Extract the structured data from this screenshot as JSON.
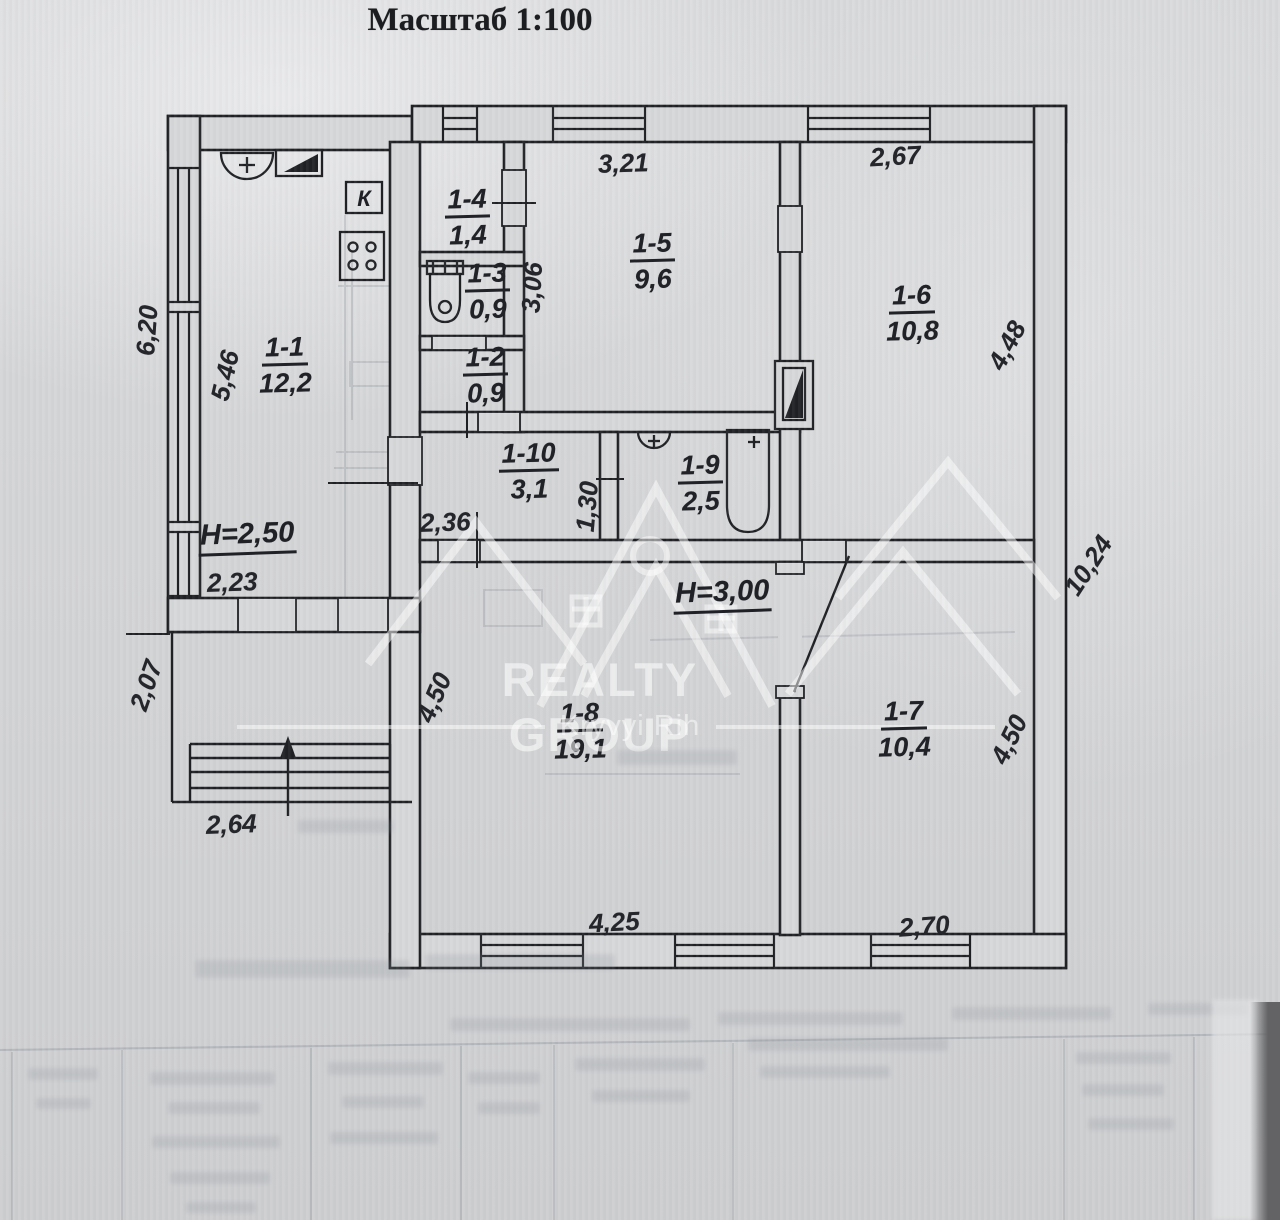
{
  "title": "Масштаб 1:100",
  "plan": {
    "kitchen_marker": "К",
    "watermark": {
      "brand": "REALTY GROUP",
      "city": "Kryvyi Rih"
    },
    "heights": {
      "wing": "Н=2,50",
      "main": "Н=3,00"
    },
    "rooms": [
      {
        "number": "1-1",
        "area": "12,2"
      },
      {
        "number": "1-2",
        "area": "0,9"
      },
      {
        "number": "1-3",
        "area": "0,9"
      },
      {
        "number": "1-4",
        "area": "1,4"
      },
      {
        "number": "1-5",
        "area": "9,6"
      },
      {
        "number": "1-6",
        "area": "10,8"
      },
      {
        "number": "1-7",
        "area": "10,4"
      },
      {
        "number": "1-8",
        "area": "19,1"
      },
      {
        "number": "1-9",
        "area": "2,5"
      },
      {
        "number": "1-10",
        "area": "3,1"
      }
    ],
    "dimensions": {
      "left_outer": "6,20",
      "room11_left": "5,46",
      "top_room15": "3,21",
      "top_room16": "2,67",
      "corridor_vert": "3,06",
      "room16_right": "4,48",
      "right_outer": "10,24",
      "hall_width": "2,36",
      "hall_height": "1,30",
      "room11_bottom": "2,23",
      "porch_side": "2,07",
      "porch_front": "2,64",
      "room18_side": "4,50",
      "room18_front": "4,25",
      "room17_front": "2,70",
      "room17_side": "4,50"
    }
  }
}
